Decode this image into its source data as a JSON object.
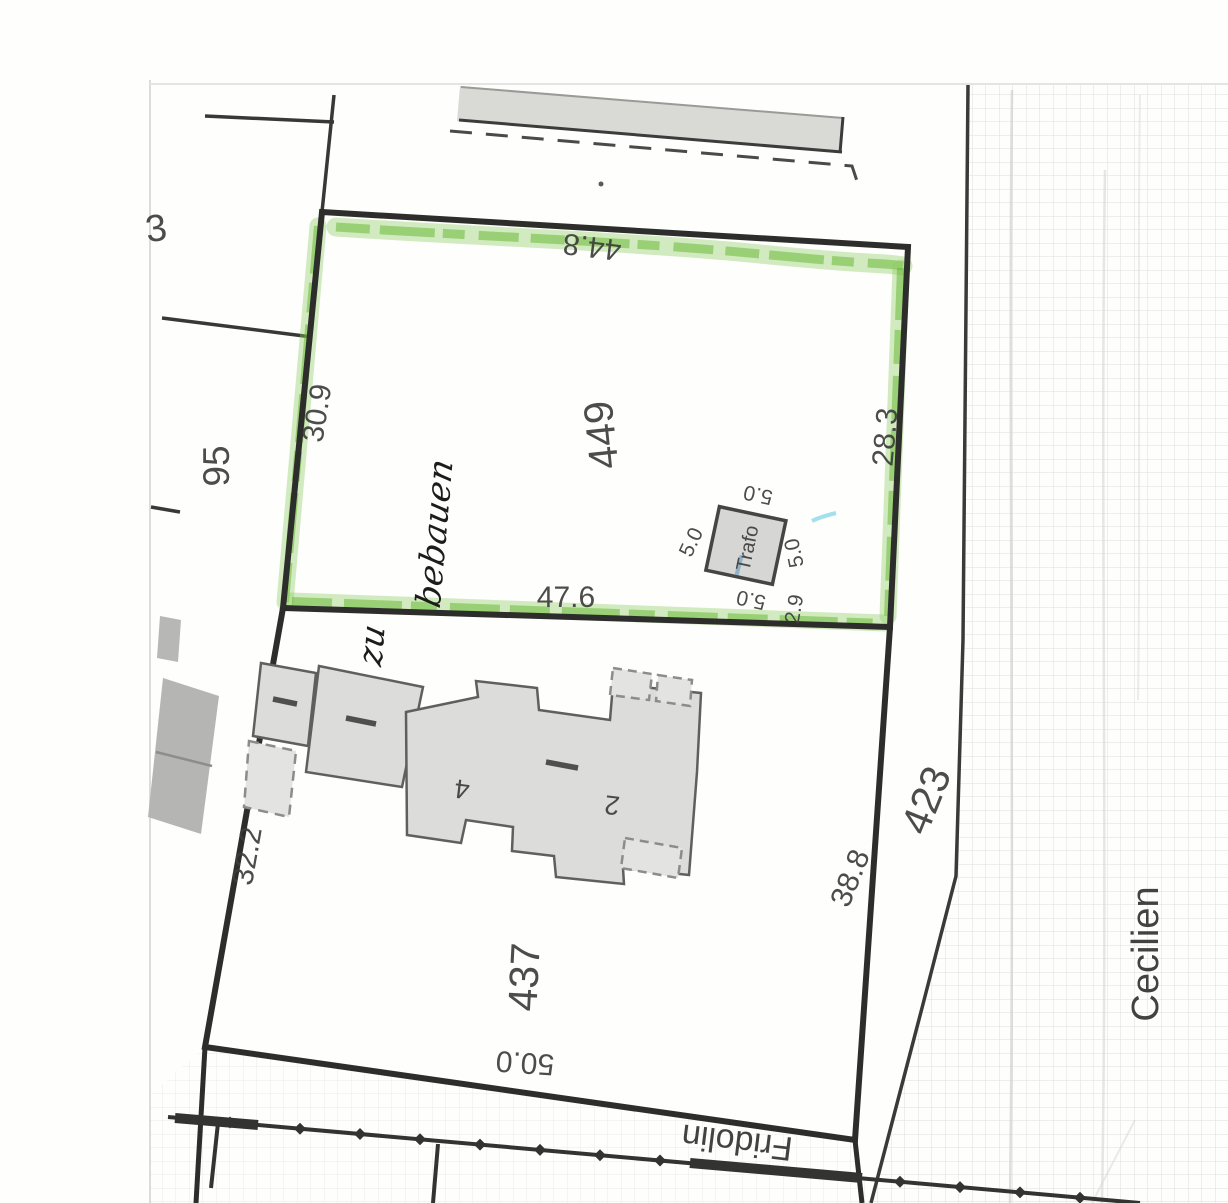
{
  "map": {
    "parcels": {
      "p449": "449",
      "p437": "437",
      "p95": "95",
      "p423": "423",
      "partial_number": "3"
    },
    "streets": {
      "east": "Cecilien",
      "south": "Fridolin"
    },
    "annotation": {
      "full": "zu bebauen",
      "word1": "zu",
      "word2": "bebauen"
    },
    "dimensions_449": {
      "north": "44.8",
      "west": "30.9",
      "east": "28.3",
      "south": "47.6"
    },
    "dimensions_437": {
      "west": "32.2",
      "east": "38.8",
      "south": "50.0"
    },
    "trafo": {
      "label": "Trafo",
      "side_top": "5.0",
      "side_left": "5.0",
      "side_right": "5.0",
      "side_bottom": "5.0",
      "offset": "2.9"
    },
    "house_numbers": {
      "left": "4",
      "right": "2"
    },
    "colors": {
      "highlight_green": "#6fbe3c",
      "boundary_dark": "#2d2d2b",
      "building_fill": "#dcdcda",
      "building_dark_fill": "#b7b7b5",
      "label_gray": "#3d3d3b"
    }
  }
}
